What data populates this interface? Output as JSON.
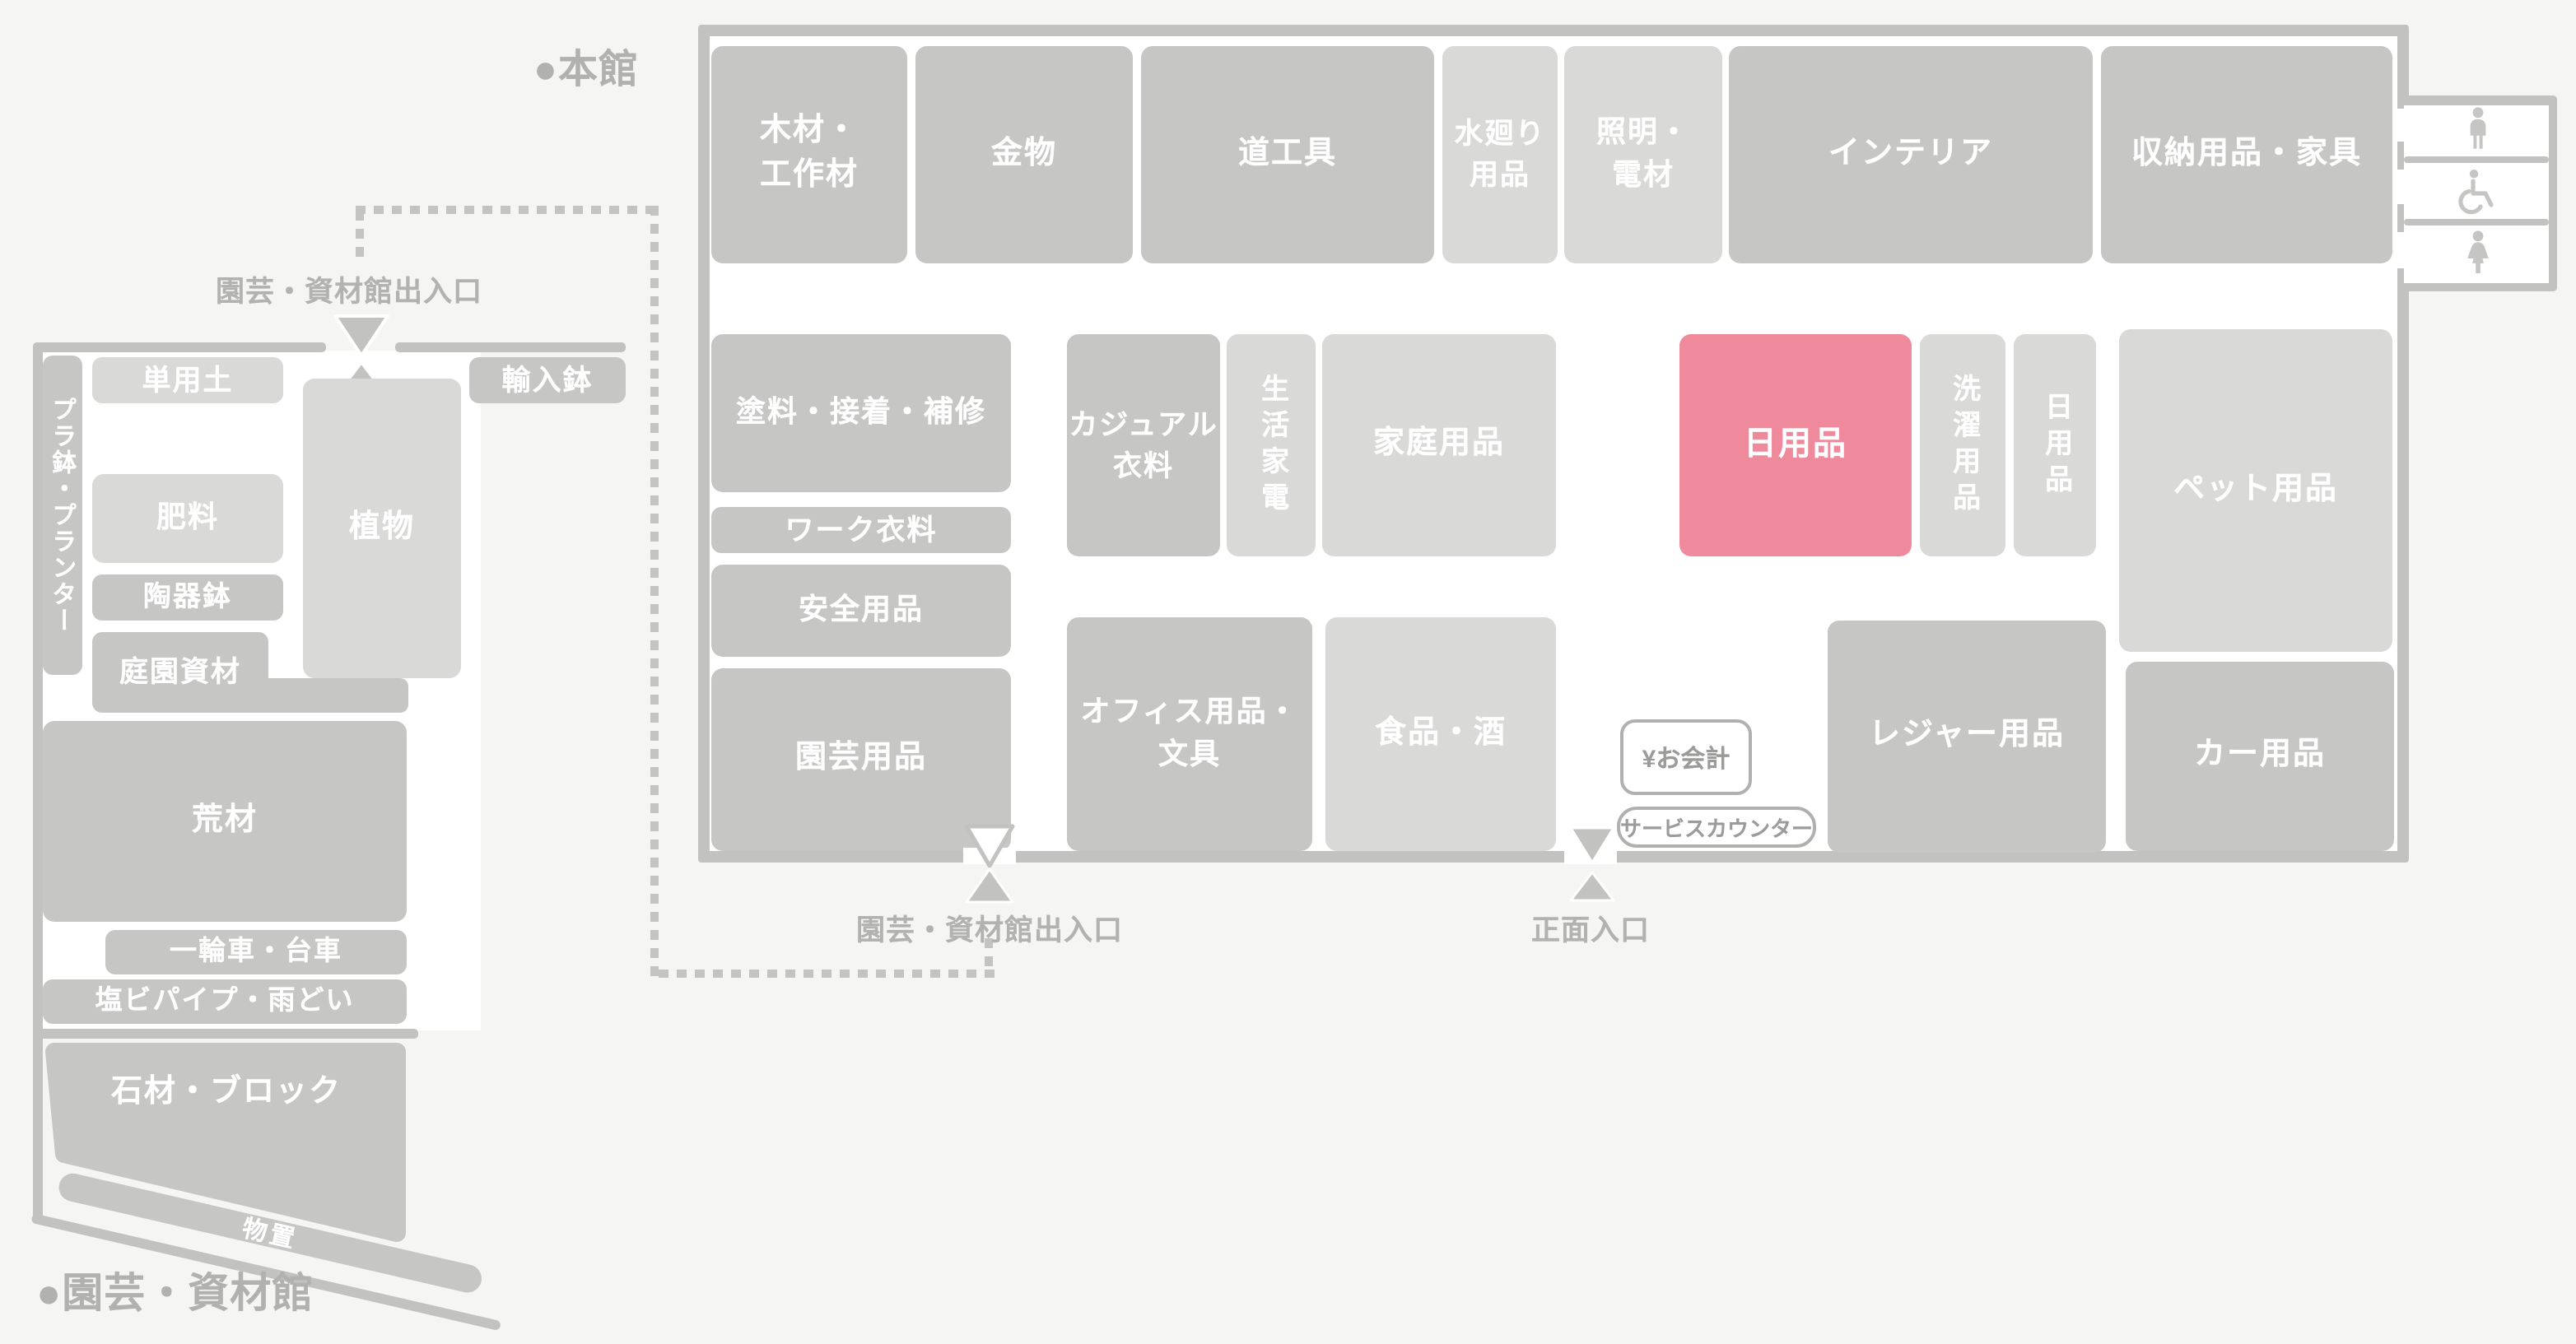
{
  "colors": {
    "background": "#f5f5f4",
    "wall_gray": "#c2c2c1",
    "block_gray": "#c6c6c5",
    "block_light_gray": "#d9d9d8",
    "highlight_pink": "#ee8a9b",
    "label_gray": "#b2b2b1"
  },
  "legend": {
    "main_building": "●本館",
    "garden_building": "●園芸・資材館"
  },
  "main_building": {
    "top_row": {
      "wood": "木材・\n工作材",
      "hardware": "金物",
      "tools": "道工具",
      "plumbing": "水廻り\n用品",
      "lighting": "照明・\n電材",
      "interior": "インテリア",
      "storage_furniture": "収納用品・家具"
    },
    "mid": {
      "paint": "塗料・接着・補修",
      "work_clothing": "ワーク衣料",
      "safety": "安全用品",
      "gardening": "園芸用品",
      "casual_clothing": "カジュアル\n衣料",
      "appliances": "生活家電",
      "household": "家庭用品",
      "daily_highlight": "日用品",
      "laundry": "洗濯用品",
      "daily": "日用品",
      "pet": "ペット用品",
      "office": "オフィス用品・\n文具",
      "food": "食品・酒",
      "leisure": "レジャー用品",
      "car": "カー用品"
    },
    "service": {
      "checkout": "¥お会計",
      "service_counter": "サービスカウンター"
    },
    "entrances": {
      "front": "正面入口",
      "garden_gate": "園芸・資材館出入口"
    },
    "restrooms": {
      "men": "mens-restroom-icon",
      "accessible": "accessible-restroom-icon",
      "women": "womens-restroom-icon"
    }
  },
  "garden_building": {
    "entrance": "園芸・資材館出入口",
    "blocks": {
      "planters": "プラ鉢・プランター",
      "soil": "単用土",
      "imported_pots": "輸入鉢",
      "plants": "植物",
      "fertilizer": "肥料",
      "ceramic_pots": "陶器鉢",
      "garden_materials": "庭園資材",
      "rough_lumber": "荒材",
      "wheelbarrow": "一輪車・台車",
      "pvc_pipe": "塩ビパイプ・雨どい",
      "stone_block": "石材・ブロック",
      "shed": "物置"
    }
  }
}
